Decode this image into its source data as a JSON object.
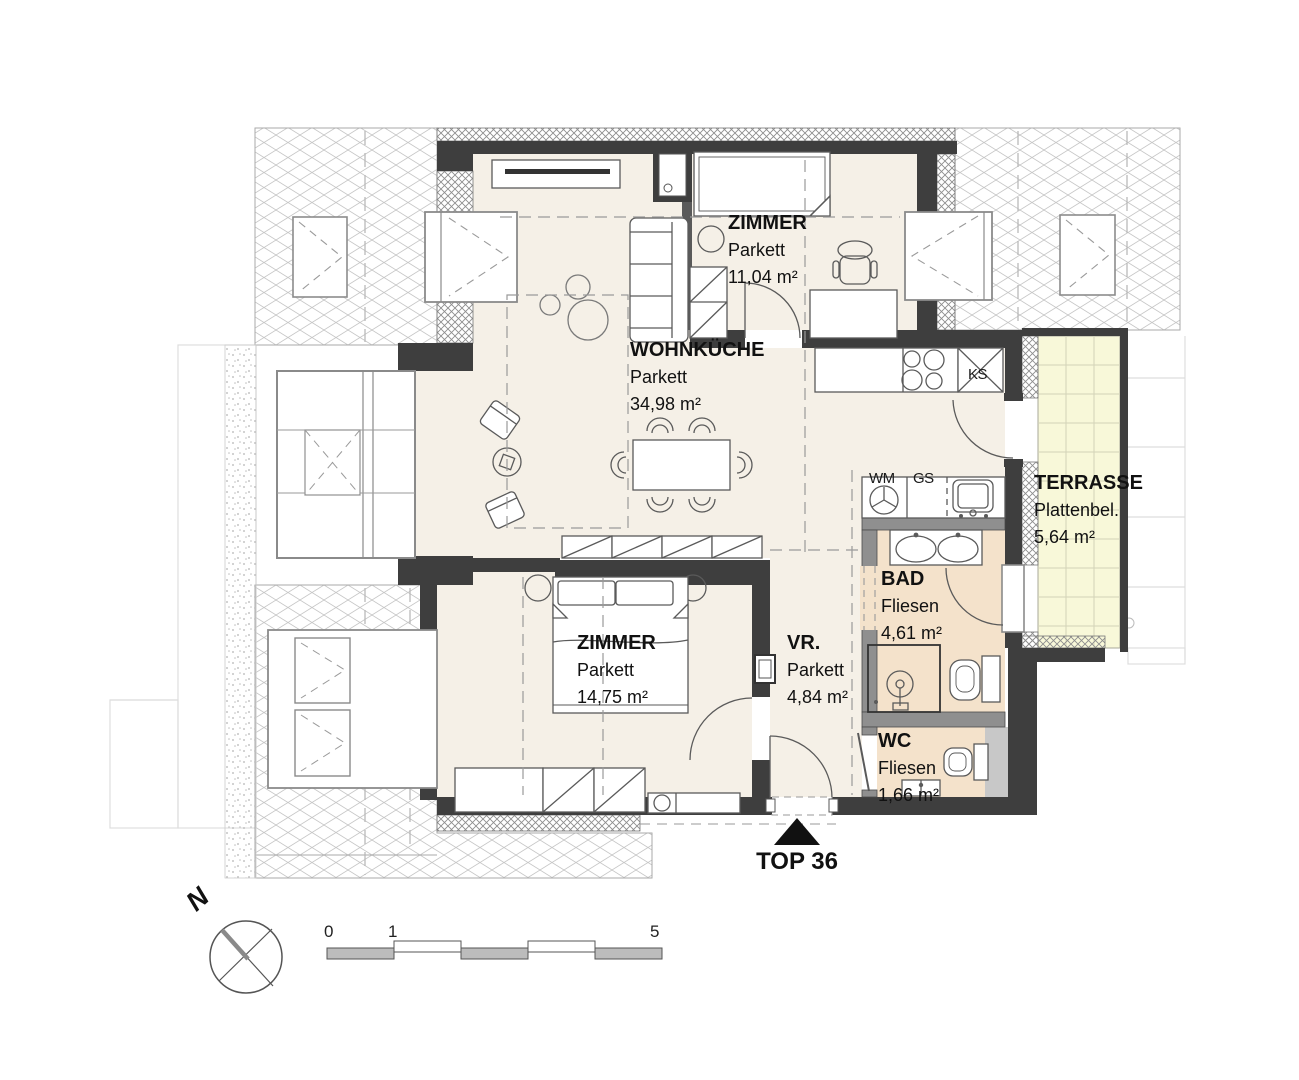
{
  "plan": {
    "rooms": [
      {
        "id": "zimmer-top",
        "name": "ZIMMER",
        "floor": "Parkett",
        "area": "11,04 m²"
      },
      {
        "id": "wohnkueche",
        "name": "WOHNKÜCHE",
        "floor": "Parkett",
        "area": "34,98 m²"
      },
      {
        "id": "terrasse",
        "name": "TERRASSE",
        "floor": "Plattenbel.",
        "area": "5,64 m²"
      },
      {
        "id": "bad",
        "name": "BAD",
        "floor": "Fliesen",
        "area": "4,61 m²"
      },
      {
        "id": "vorraum",
        "name": "VR.",
        "floor": "Parkett",
        "area": "4,84 m²"
      },
      {
        "id": "zimmer-bottom",
        "name": "ZIMMER",
        "floor": "Parkett",
        "area": "14,75 m²"
      },
      {
        "id": "wc",
        "name": "WC",
        "floor": "Fliesen",
        "area": "1,66 m²"
      }
    ],
    "appliances": {
      "wm": "WM",
      "gs": "GS",
      "ks": "KS"
    },
    "unit_label": "TOP 36",
    "compass": {
      "label": "N"
    },
    "scale_bar": {
      "start": "0",
      "one": "1",
      "end": "5"
    },
    "colors": {
      "wall": "#3e3e3e",
      "partition": "#8f8f8f",
      "floor_parquet": "#f5f0e7",
      "floor_tiles": "#f4e2cb",
      "terrace": "#f8f8d9",
      "hatch_line": "#c4c4c4",
      "furniture_line": "#5a5a5a"
    }
  }
}
